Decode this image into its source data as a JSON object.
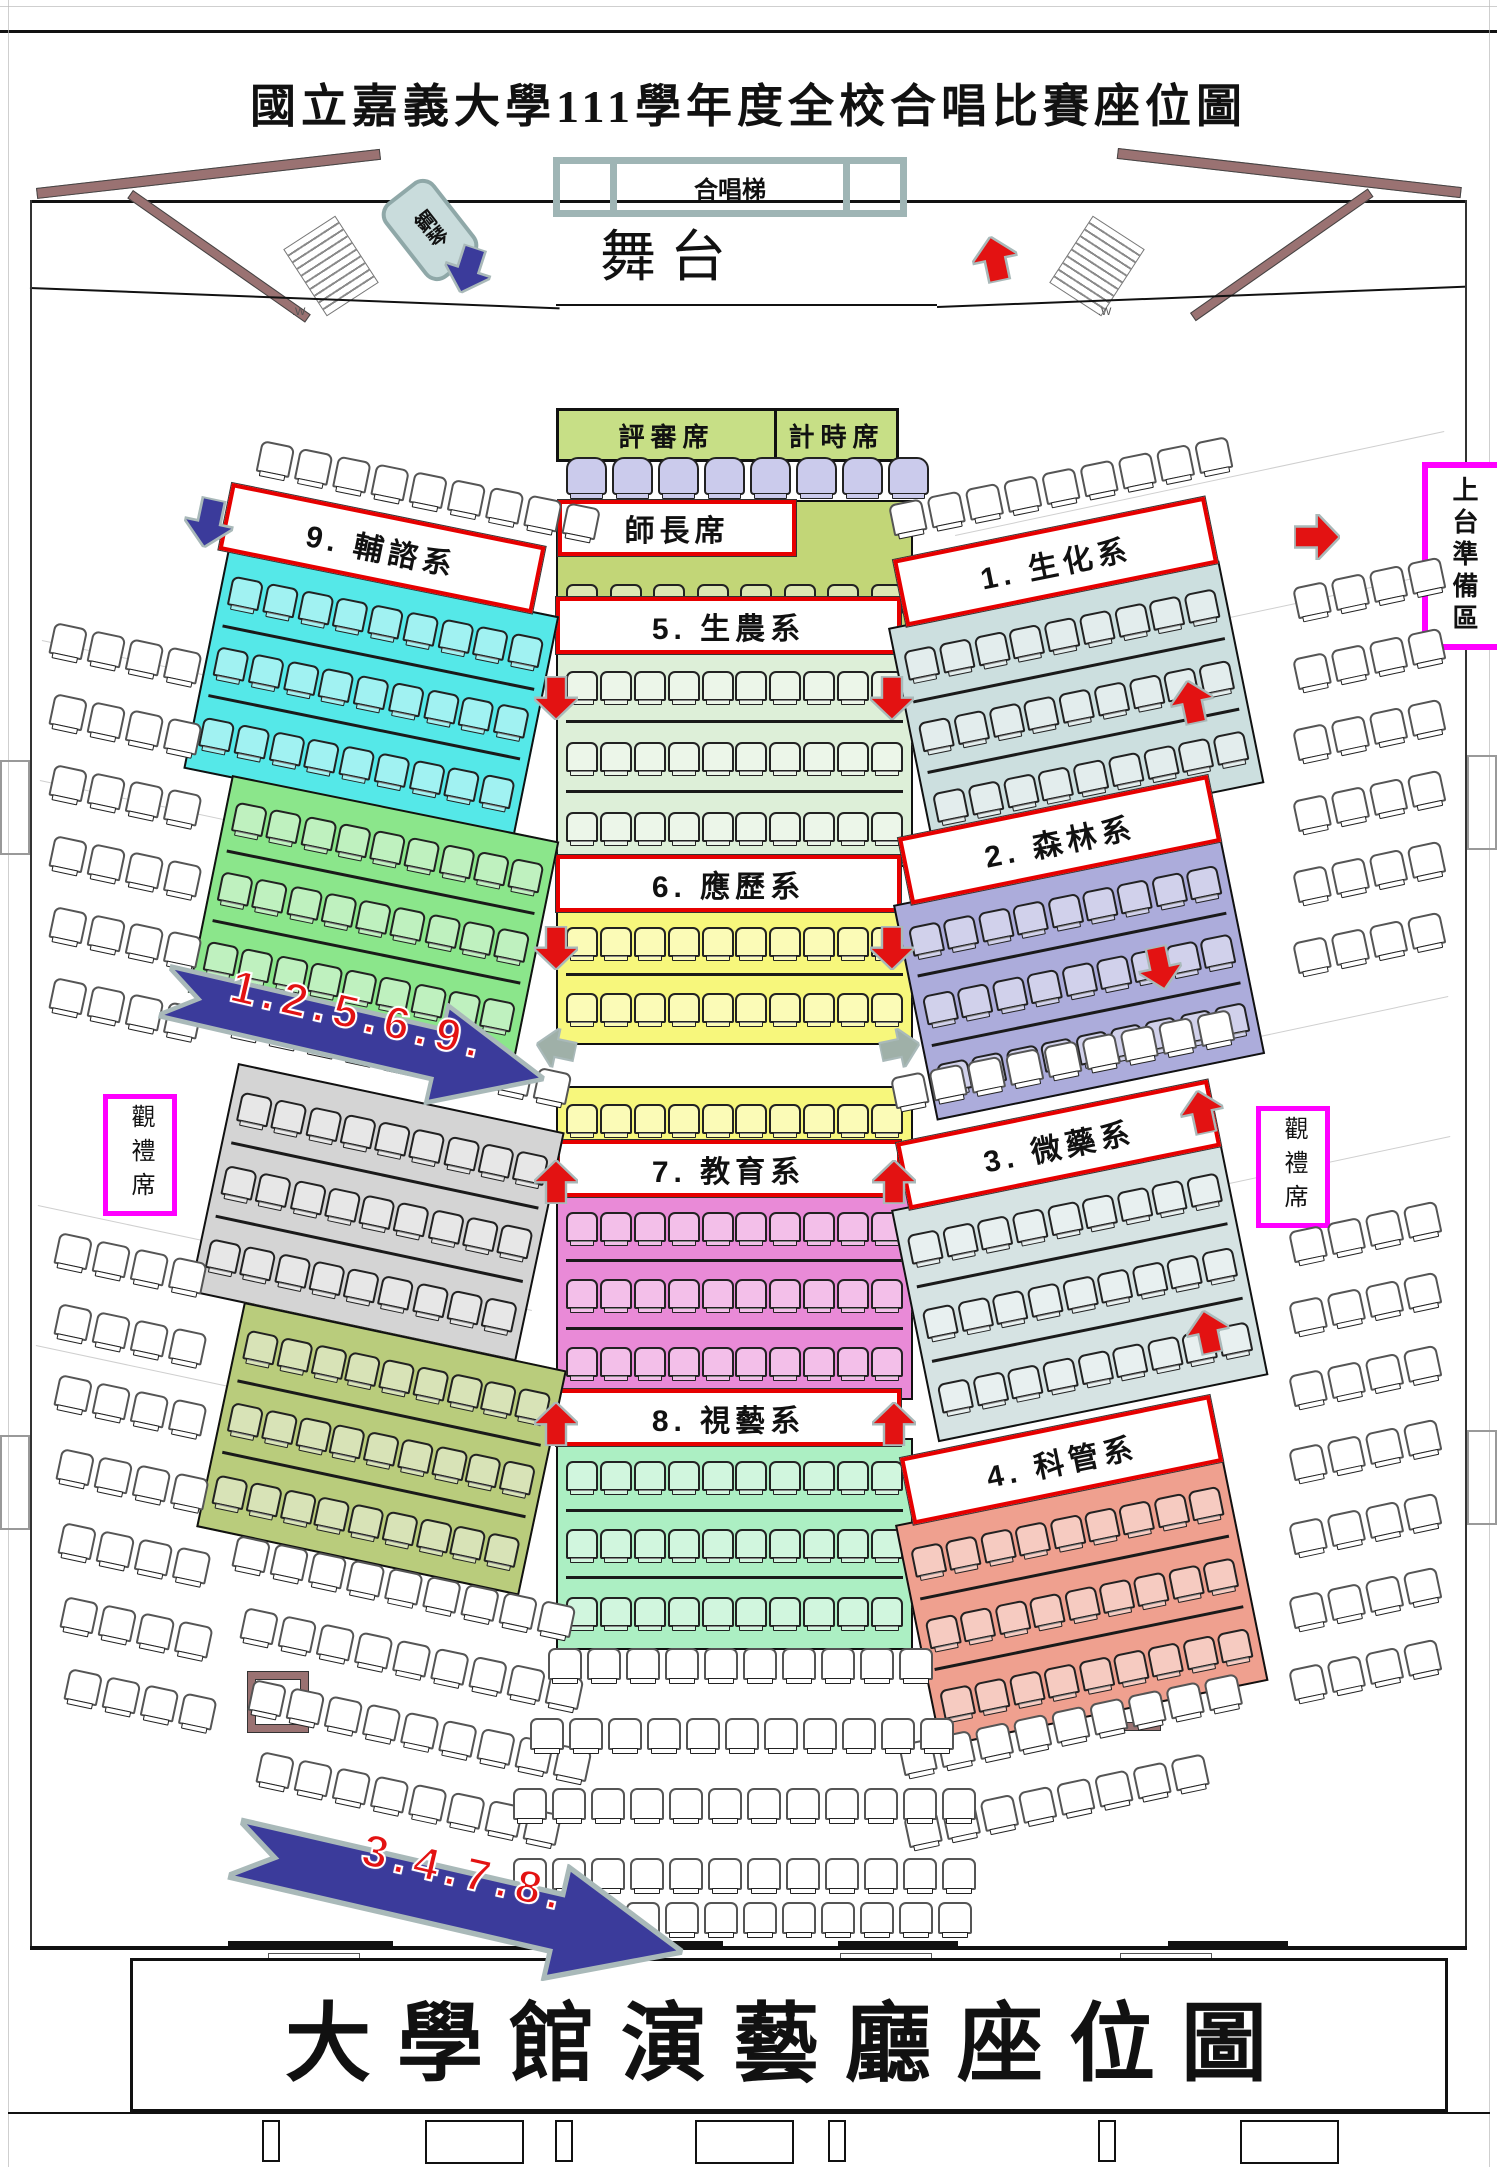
{
  "title": "國立嘉義大學111學年度全校合唱比賽座位圖",
  "footer_title": "大學館演藝廳座位圖",
  "stage": {
    "label": "舞台",
    "riser_label": "合唱梯",
    "piano_label": "鋼琴",
    "stair_label": ".W"
  },
  "judges_box": {
    "judges": "評審席",
    "timer": "計時席"
  },
  "galleries": {
    "left": "觀禮席",
    "right": "觀禮席",
    "prep": "上台準備區"
  },
  "colors": {
    "label_border": "#e60000",
    "magenta": "#ff00ff",
    "flow_blue": "#3b3b9b",
    "flow_text": "#e31212",
    "arrow_outline": "#a9b9b9",
    "wall_maroon": "#9a7272",
    "frame_teal": "#9fb5b5",
    "judges_bg": "#c7df86",
    "seat_lavender": "#cbcbec"
  },
  "flow_arrows": [
    {
      "label": "1.2.5.6.9.",
      "x": 176,
      "y": 940,
      "w": 390,
      "h": 105,
      "rot": 13
    },
    {
      "label": "3.4.7.8.",
      "x": 248,
      "y": 1790,
      "w": 460,
      "h": 120,
      "rot": 13
    }
  ],
  "sections": [
    {
      "id": "teachers",
      "label": "師長席",
      "color": "#c2d677",
      "block": {
        "x": 556,
        "y": 500,
        "w": 337,
        "h": 98,
        "rot": 0,
        "pad_top": 48
      },
      "rows": 1,
      "cols": 8,
      "label_box": {
        "x": 558,
        "y": 500,
        "w": 230,
        "h": 48,
        "rot": 0
      }
    },
    {
      "id": "5",
      "label": "5. 生農系",
      "color": "#ddefd8",
      "block": {
        "x": 556,
        "y": 646,
        "w": 337,
        "h": 209,
        "rot": 0
      },
      "rows": 3,
      "cols": 10,
      "label_box": {
        "x": 556,
        "y": 597,
        "w": 337,
        "h": 49,
        "rot": 0
      }
    },
    {
      "id": "6",
      "label": "6. 應歷系",
      "color": "#f7f77c",
      "block": {
        "x": 556,
        "y": 904,
        "w": 337,
        "h": 129,
        "rot": 0
      },
      "rows": 2,
      "cols": 10,
      "label_box": {
        "x": 556,
        "y": 855,
        "w": 337,
        "h": 49,
        "rot": 0
      }
    },
    {
      "id": "6b",
      "label": null,
      "color": "#f7f77c",
      "block": {
        "x": 556,
        "y": 1086,
        "w": 337,
        "h": 54,
        "rot": 0
      },
      "rows": 1,
      "cols": 10
    },
    {
      "id": "7",
      "label": "7. 教育系",
      "color": "#e98ad7",
      "block": {
        "x": 556,
        "y": 1189,
        "w": 337,
        "h": 199,
        "rot": 0
      },
      "rows": 3,
      "cols": 10,
      "label_box": {
        "x": 556,
        "y": 1140,
        "w": 337,
        "h": 49,
        "rot": 0
      }
    },
    {
      "id": "8",
      "label": "8. 視藝系",
      "color": "#acefc3",
      "block": {
        "x": 556,
        "y": 1438,
        "w": 337,
        "h": 200,
        "rot": 0
      },
      "rows": 3,
      "cols": 10,
      "label_box": {
        "x": 556,
        "y": 1389,
        "w": 337,
        "h": 49,
        "rot": 0
      }
    },
    {
      "id": "9",
      "label": "9. 輔諮系",
      "color": "#55e8e8",
      "block": {
        "x": 228,
        "y": 549,
        "w": 318,
        "h": 212,
        "rot": 11.5
      },
      "rows": 3,
      "cols": 9,
      "label_box": {
        "x": 232,
        "y": 483,
        "w": 312,
        "h": 60,
        "rot": 11.5
      }
    },
    {
      "id": "9b",
      "label": null,
      "color": "#8be68b",
      "block": {
        "x": 232,
        "y": 775,
        "w": 314,
        "h": 210,
        "rot": 11.5
      },
      "rows": 3,
      "cols": 9
    },
    {
      "id": "left-gray",
      "label": null,
      "color": "#d4d4d4",
      "block": {
        "x": 238,
        "y": 1063,
        "w": 314,
        "h": 222,
        "rot": 12
      },
      "rows": 3,
      "cols": 9
    },
    {
      "id": "left-olive",
      "label": null,
      "color": "#b9cc7c",
      "block": {
        "x": 244,
        "y": 1302,
        "w": 310,
        "h": 218,
        "rot": 12
      },
      "rows": 3,
      "cols": 9
    },
    {
      "id": "1",
      "label": "1. 生化系",
      "color": "#ccdfdf",
      "block": {
        "x": 888,
        "y": 628,
        "w": 318,
        "h": 215,
        "rot": -11.5
      },
      "rows": 3,
      "cols": 9,
      "label_box": {
        "x": 893,
        "y": 560,
        "w": 310,
        "h": 60,
        "rot": -11.5
      }
    },
    {
      "id": "2",
      "label": "2. 森林系",
      "color": "#acacdb",
      "block": {
        "x": 893,
        "y": 905,
        "w": 315,
        "h": 208,
        "rot": -11.5
      },
      "rows": 3,
      "cols": 9,
      "label_box": {
        "x": 898,
        "y": 838,
        "w": 308,
        "h": 60,
        "rot": -11.5
      }
    },
    {
      "id": "3",
      "label": "3. 微藥系",
      "color": "#d6e3e3",
      "block": {
        "x": 891,
        "y": 1210,
        "w": 317,
        "h": 225,
        "rot": -11.5
      },
      "rows": 3,
      "cols": 9,
      "label_box": {
        "x": 896,
        "y": 1143,
        "w": 310,
        "h": 60,
        "rot": -11.5
      }
    },
    {
      "id": "4",
      "label": "4. 科管系",
      "color": "#efa08f",
      "block": {
        "x": 895,
        "y": 1525,
        "w": 315,
        "h": 215,
        "rot": -11.5
      },
      "rows": 3,
      "cols": 9,
      "label_box": {
        "x": 900,
        "y": 1458,
        "w": 308,
        "h": 60,
        "rot": -11.5
      }
    }
  ],
  "seat_rows": [
    {
      "x": 566,
      "y": 457,
      "count": 8,
      "rot": 0,
      "style": "lavender",
      "sw": 37,
      "sh": 34
    },
    {
      "x": 262,
      "y": 440,
      "count": 9,
      "rot": 11.5
    },
    {
      "x": 888,
      "y": 505,
      "count": 9,
      "rot": -11.5
    },
    {
      "x": 234,
      "y": 1002,
      "count": 9,
      "rot": 12
    },
    {
      "x": 890,
      "y": 1078,
      "count": 9,
      "rot": -11.5
    },
    {
      "x": 238,
      "y": 1535,
      "count": 9,
      "rot": 12
    },
    {
      "x": 246,
      "y": 1607,
      "count": 9,
      "rot": 12
    },
    {
      "x": 254,
      "y": 1679,
      "count": 9,
      "rot": 12
    },
    {
      "x": 262,
      "y": 1751,
      "count": 8,
      "rot": 12
    },
    {
      "x": 898,
      "y": 1745,
      "count": 9,
      "rot": -12
    },
    {
      "x": 903,
      "y": 1817,
      "count": 8,
      "rot": -12
    },
    {
      "x": 548,
      "y": 1648,
      "count": 10,
      "rot": 0
    },
    {
      "x": 530,
      "y": 1718,
      "count": 11,
      "rot": 0
    },
    {
      "x": 513,
      "y": 1788,
      "count": 12,
      "rot": 0
    },
    {
      "x": 513,
      "y": 1858,
      "count": 12,
      "rot": 0
    },
    {
      "x": 548,
      "y": 1902,
      "count": 11,
      "rot": 0
    },
    {
      "x": 55,
      "y": 622,
      "count": 4,
      "rot": 12
    },
    {
      "x": 55,
      "y": 693,
      "count": 4,
      "rot": 12
    },
    {
      "x": 55,
      "y": 764,
      "count": 4,
      "rot": 12
    },
    {
      "x": 55,
      "y": 835,
      "count": 4,
      "rot": 12
    },
    {
      "x": 55,
      "y": 906,
      "count": 4,
      "rot": 12
    },
    {
      "x": 55,
      "y": 977,
      "count": 4,
      "rot": 12
    },
    {
      "x": 60,
      "y": 1232,
      "count": 4,
      "rot": 12
    },
    {
      "x": 60,
      "y": 1303,
      "count": 4,
      "rot": 12
    },
    {
      "x": 60,
      "y": 1374,
      "count": 4,
      "rot": 12
    },
    {
      "x": 62,
      "y": 1448,
      "count": 4,
      "rot": 12
    },
    {
      "x": 64,
      "y": 1522,
      "count": 4,
      "rot": 12
    },
    {
      "x": 66,
      "y": 1596,
      "count": 4,
      "rot": 12
    },
    {
      "x": 70,
      "y": 1668,
      "count": 4,
      "rot": 12
    },
    {
      "x": 1292,
      "y": 588,
      "count": 4,
      "rot": -12
    },
    {
      "x": 1292,
      "y": 659,
      "count": 4,
      "rot": -12
    },
    {
      "x": 1292,
      "y": 730,
      "count": 4,
      "rot": -12
    },
    {
      "x": 1292,
      "y": 801,
      "count": 4,
      "rot": -12
    },
    {
      "x": 1292,
      "y": 872,
      "count": 4,
      "rot": -12
    },
    {
      "x": 1292,
      "y": 943,
      "count": 4,
      "rot": -12
    },
    {
      "x": 1288,
      "y": 1232,
      "count": 4,
      "rot": -12
    },
    {
      "x": 1288,
      "y": 1303,
      "count": 4,
      "rot": -12
    },
    {
      "x": 1288,
      "y": 1376,
      "count": 4,
      "rot": -12
    },
    {
      "x": 1288,
      "y": 1450,
      "count": 4,
      "rot": -12
    },
    {
      "x": 1288,
      "y": 1524,
      "count": 4,
      "rot": -12
    },
    {
      "x": 1288,
      "y": 1598,
      "count": 4,
      "rot": -12
    },
    {
      "x": 1288,
      "y": 1670,
      "count": 4,
      "rot": -12
    }
  ],
  "arrows": [
    {
      "x": 444,
      "y": 246,
      "dir": "down",
      "color": "#3b3b9b",
      "rot": 18,
      "size": 48
    },
    {
      "x": 972,
      "y": 236,
      "dir": "up",
      "color": "#e31212",
      "rot": -12,
      "size": 46
    },
    {
      "x": 184,
      "y": 498,
      "dir": "down",
      "color": "#3b3b9b",
      "rot": 12,
      "size": 50
    },
    {
      "x": 1294,
      "y": 514,
      "dir": "right",
      "color": "#e31212",
      "rot": 0,
      "size": 46
    },
    {
      "x": 534,
      "y": 676,
      "dir": "down",
      "color": "#e31212",
      "rot": 0,
      "size": 44
    },
    {
      "x": 870,
      "y": 676,
      "dir": "down",
      "color": "#e31212",
      "rot": 0,
      "size": 44
    },
    {
      "x": 1170,
      "y": 680,
      "dir": "up",
      "color": "#e31212",
      "rot": -12,
      "size": 44
    },
    {
      "x": 534,
      "y": 926,
      "dir": "down",
      "color": "#e31212",
      "rot": 0,
      "size": 44
    },
    {
      "x": 870,
      "y": 926,
      "dir": "down",
      "color": "#e31212",
      "rot": 0,
      "size": 44
    },
    {
      "x": 1138,
      "y": 946,
      "dir": "down",
      "color": "#e31212",
      "rot": -12,
      "size": 44
    },
    {
      "x": 536,
      "y": 1028,
      "dir": "left",
      "color": "#9fb0a8",
      "rot": 12,
      "size": 40
    },
    {
      "x": 880,
      "y": 1028,
      "dir": "right",
      "color": "#9fb0a8",
      "rot": -12,
      "size": 40
    },
    {
      "x": 534,
      "y": 1160,
      "dir": "up",
      "color": "#e31212",
      "rot": 0,
      "size": 44
    },
    {
      "x": 872,
      "y": 1160,
      "dir": "up",
      "color": "#e31212",
      "rot": 0,
      "size": 44
    },
    {
      "x": 1180,
      "y": 1090,
      "dir": "up",
      "color": "#e31212",
      "rot": -12,
      "size": 44
    },
    {
      "x": 1186,
      "y": 1310,
      "dir": "up",
      "color": "#e31212",
      "rot": -12,
      "size": 44
    },
    {
      "x": 534,
      "y": 1402,
      "dir": "up",
      "color": "#e31212",
      "rot": 0,
      "size": 44
    },
    {
      "x": 872,
      "y": 1402,
      "dir": "up",
      "color": "#e31212",
      "rot": 0,
      "size": 44
    }
  ]
}
